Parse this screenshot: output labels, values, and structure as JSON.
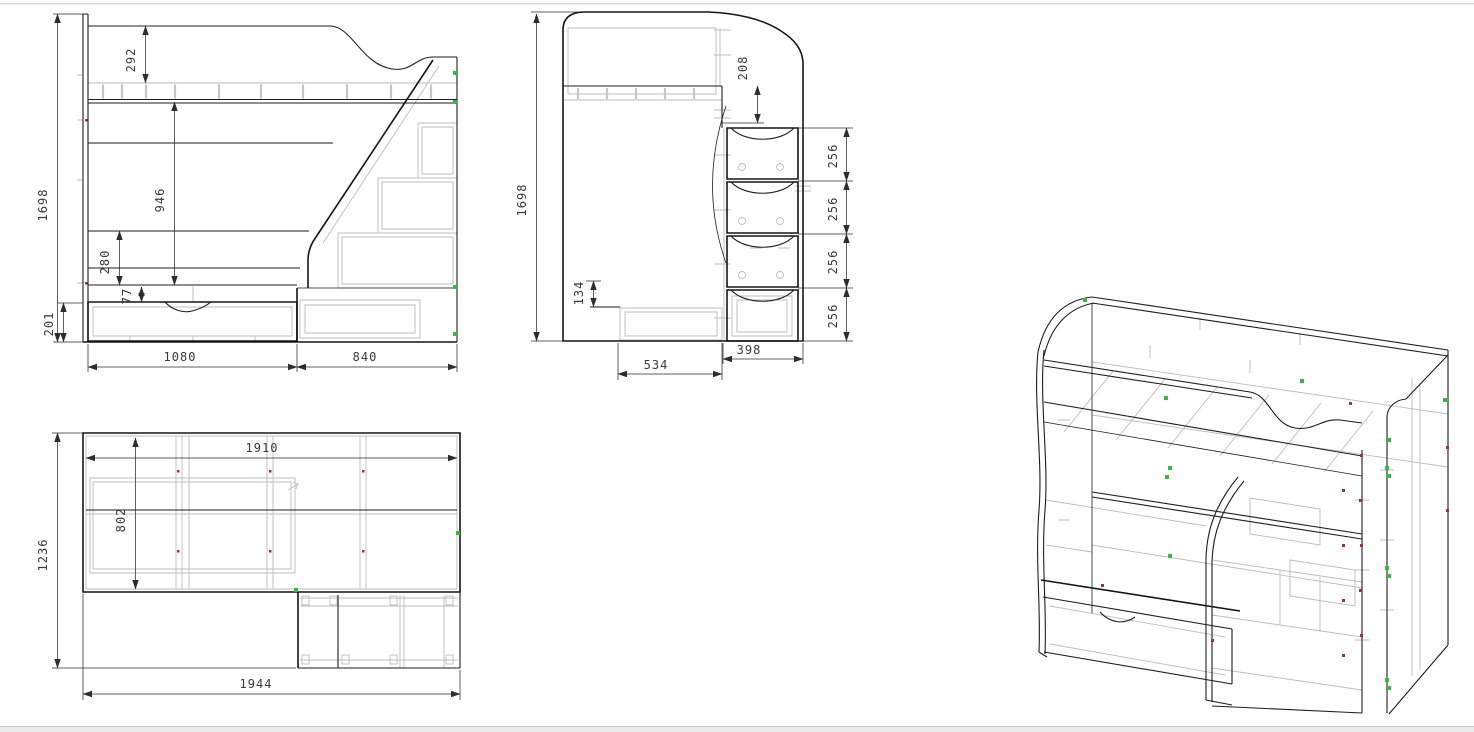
{
  "colors": {
    "line": "#1e1e1e",
    "hidden_line": "#bdbdbd",
    "dimension": "#2d2d2d",
    "marker_green": "#2fbf3a",
    "marker_red": "#9e3434",
    "page_edge": "#d8d8d8"
  },
  "views": {
    "front": {
      "dims": {
        "total_height": "1698",
        "top_section": "292",
        "opening_height": "946",
        "base_section": "280",
        "drawer_offset": "77",
        "plinth_height": "201",
        "bed_width": "1080",
        "stairs_width": "840"
      }
    },
    "side": {
      "dims": {
        "total_height": "1698",
        "rail_offset": "208",
        "step_1": "256",
        "step_2": "256",
        "step_3": "256",
        "step_4": "256",
        "plinth_step": "134",
        "bed_depth": "534",
        "stairs_depth": "398"
      }
    },
    "top": {
      "dims": {
        "overall_depth": "1236",
        "inner_length": "1910",
        "inner_width": "802",
        "overall_length": "1944"
      }
    }
  }
}
